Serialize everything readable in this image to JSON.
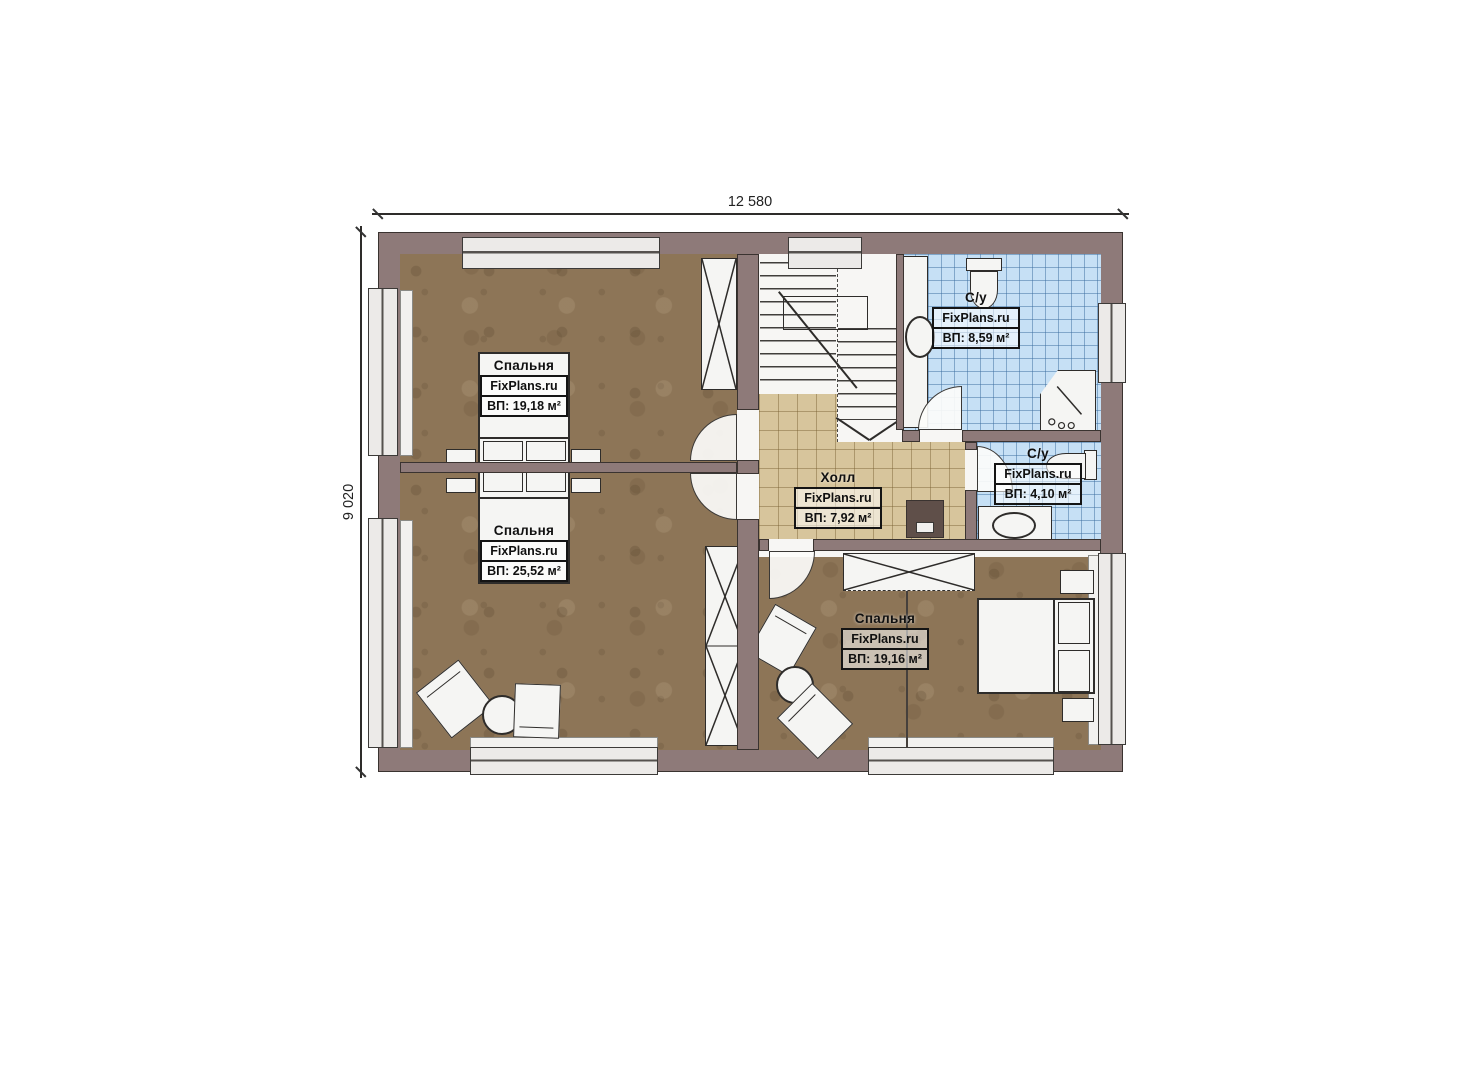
{
  "page": {
    "background": "#ffffff"
  },
  "dimensions": {
    "width_label": "12 580",
    "height_label": "9 020"
  },
  "rooms": [
    {
      "name": "Спальня",
      "brand": "FixPlans.ru",
      "area": "ВП: 19,18 м²"
    },
    {
      "name": "Спальня",
      "brand": "FixPlans.ru",
      "area": "ВП: 25,52 м²"
    },
    {
      "name": "Холл",
      "brand": "FixPlans.ru",
      "area": "ВП: 7,92 м²"
    },
    {
      "name": "С/у",
      "brand": "FixPlans.ru",
      "area": "ВП: 8,59 м²"
    },
    {
      "name": "С/у",
      "brand": "FixPlans.ru",
      "area": "ВП: 4,10 м²"
    },
    {
      "name": "Спальня",
      "brand": "FixPlans.ru",
      "area": "ВП: 19,16 м²"
    }
  ],
  "colors": {
    "wall": "#8e7a79",
    "wall-dark": "#3a3330",
    "floor": "#8d7557",
    "hall-tile": "#d7c59c",
    "bath-tile": "#c6e0f5",
    "fixture": "#f5f5f3",
    "outline": "#2e2c2a"
  }
}
